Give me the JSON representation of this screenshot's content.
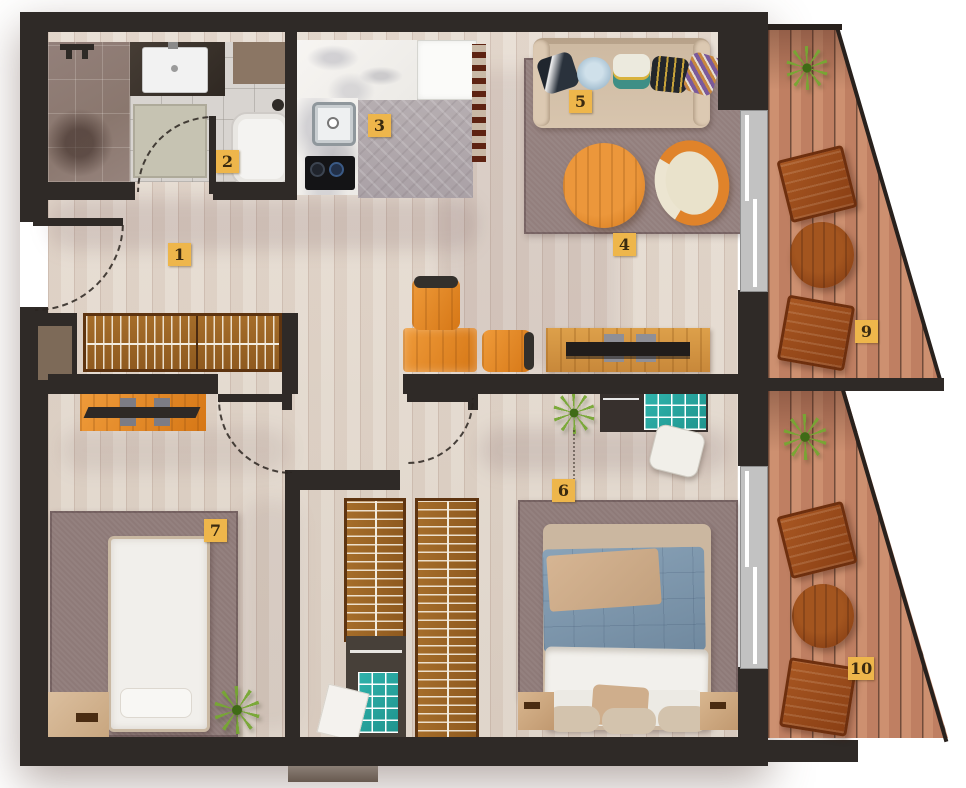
{
  "floorplan": {
    "unit_labels": [
      {
        "id": "entry-hall",
        "number": "1"
      },
      {
        "id": "bathroom",
        "number": "2"
      },
      {
        "id": "kitchen",
        "number": "3"
      },
      {
        "id": "living-room",
        "number": "4"
      },
      {
        "id": "sofa-zone",
        "number": "5"
      },
      {
        "id": "bedroom-main",
        "number": "6"
      },
      {
        "id": "bedroom-small",
        "number": "7"
      },
      {
        "id": "balcony-upper",
        "number": "9"
      },
      {
        "id": "balcony-lower",
        "number": "10"
      }
    ],
    "palette": {
      "wall": "#2f2a27",
      "floor_wood": "#e0d6cb",
      "floor_tile": "#d8d4d0",
      "floor_shower": "#8d7a72",
      "floor_mosaic": "#b2aaad",
      "rug": "#8e7a78",
      "furniture_orange": "#e08524",
      "wardrobe_wood": "#9c6426",
      "balcony_deck": "#c98a6d",
      "patio_furniture": "#94471a",
      "teal_accent": "#2aa7a0",
      "bed_blue": "#7e99b0",
      "sofa_beige": "#d5c2ab",
      "label_bg": "#eeb64b",
      "label_text": "#3a2a10"
    }
  }
}
